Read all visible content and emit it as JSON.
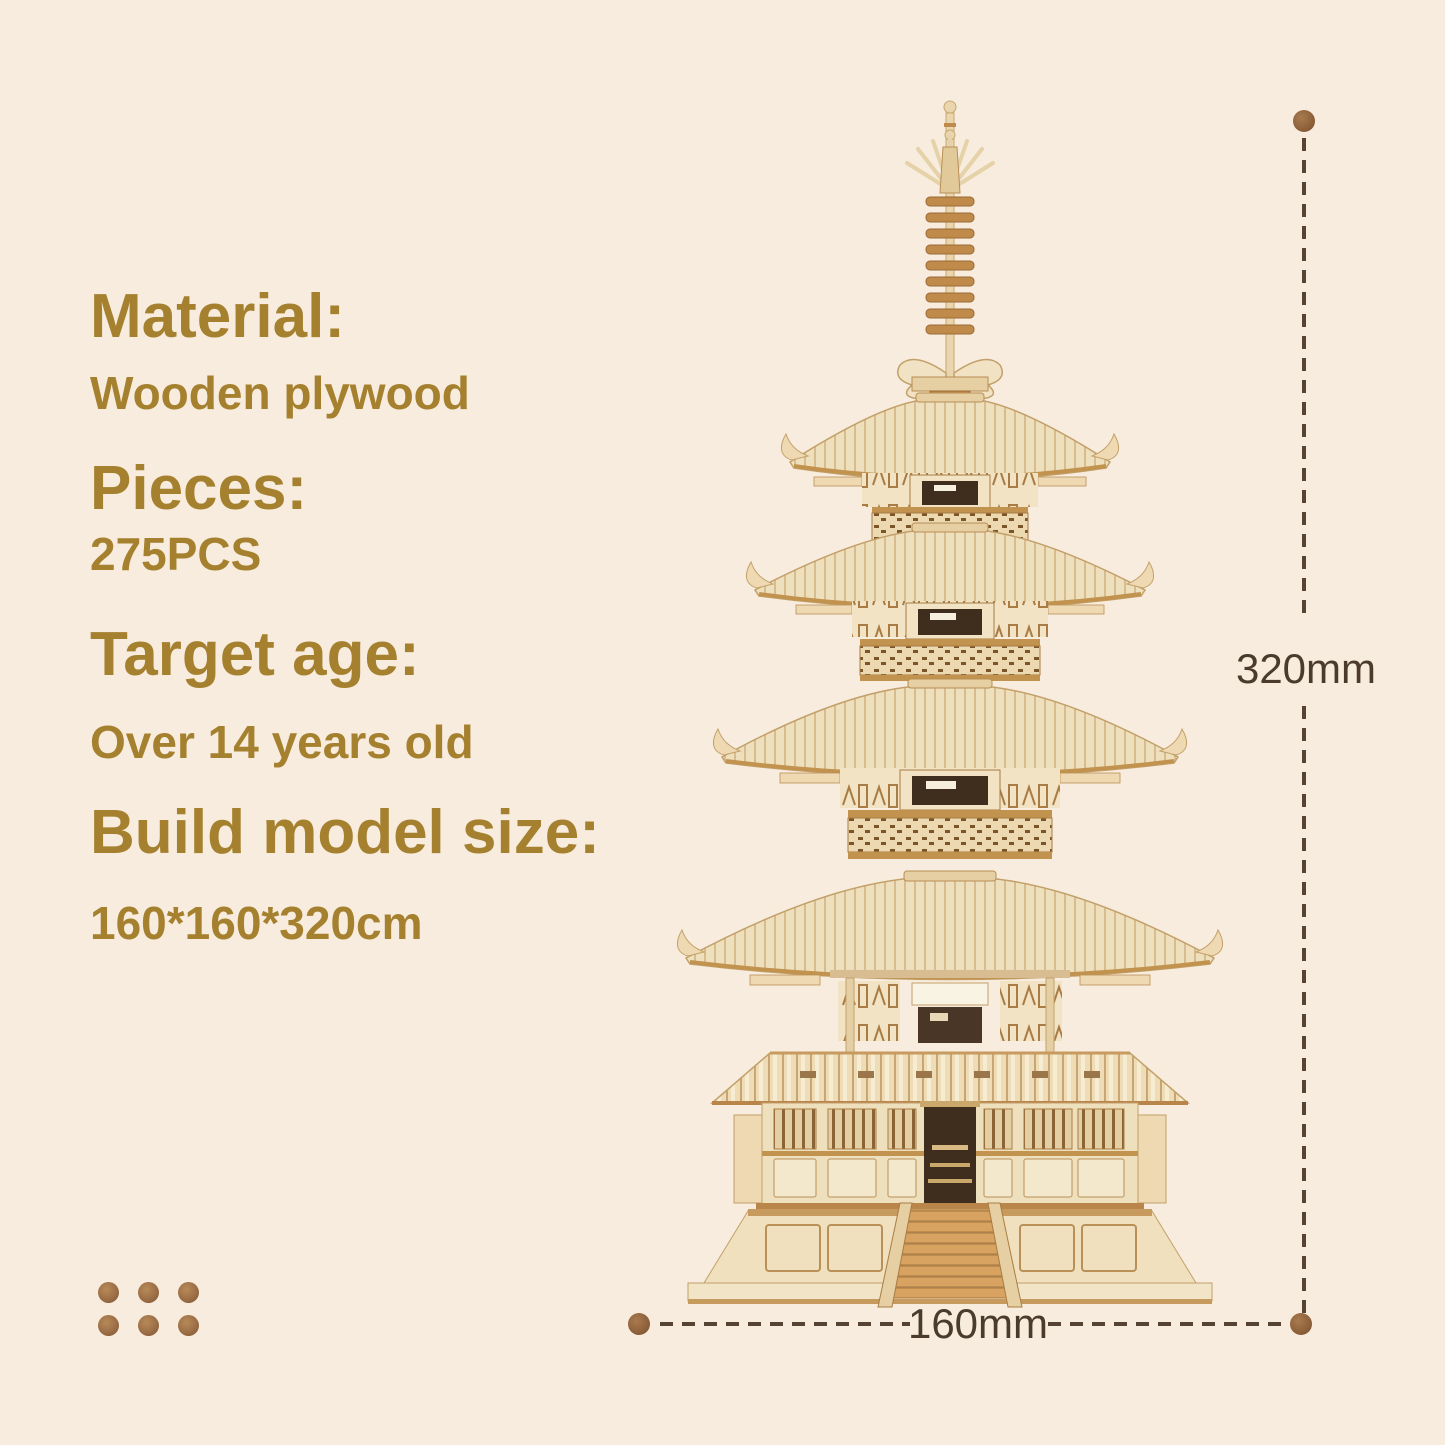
{
  "specs": [
    {
      "label": "Material:",
      "value": "Wooden plywood"
    },
    {
      "label": "Pieces:",
      "value": "275PCS"
    },
    {
      "label": "Target age:",
      "value": "Over 14 years old"
    },
    {
      "label": "Build model size:",
      "value": "160*160*320cm"
    }
  ],
  "dimensions": {
    "height_label": "320mm",
    "width_label": "160mm"
  },
  "colors": {
    "background": "#f7ecdd",
    "accent_gold": "#a5812f",
    "dimension_text": "#4a3b2c",
    "dash_line": "#554334",
    "marker_dot": "#91633c",
    "ornament_dot": "#9c6e46",
    "wood_light": "#f2e4c6",
    "wood_mid": "#e9d6ae",
    "wood_tan": "#c3a06a",
    "wood_brown": "#b9854a",
    "ridge_brown": "#c79a5e",
    "door_dark": "#3f2e1d"
  }
}
